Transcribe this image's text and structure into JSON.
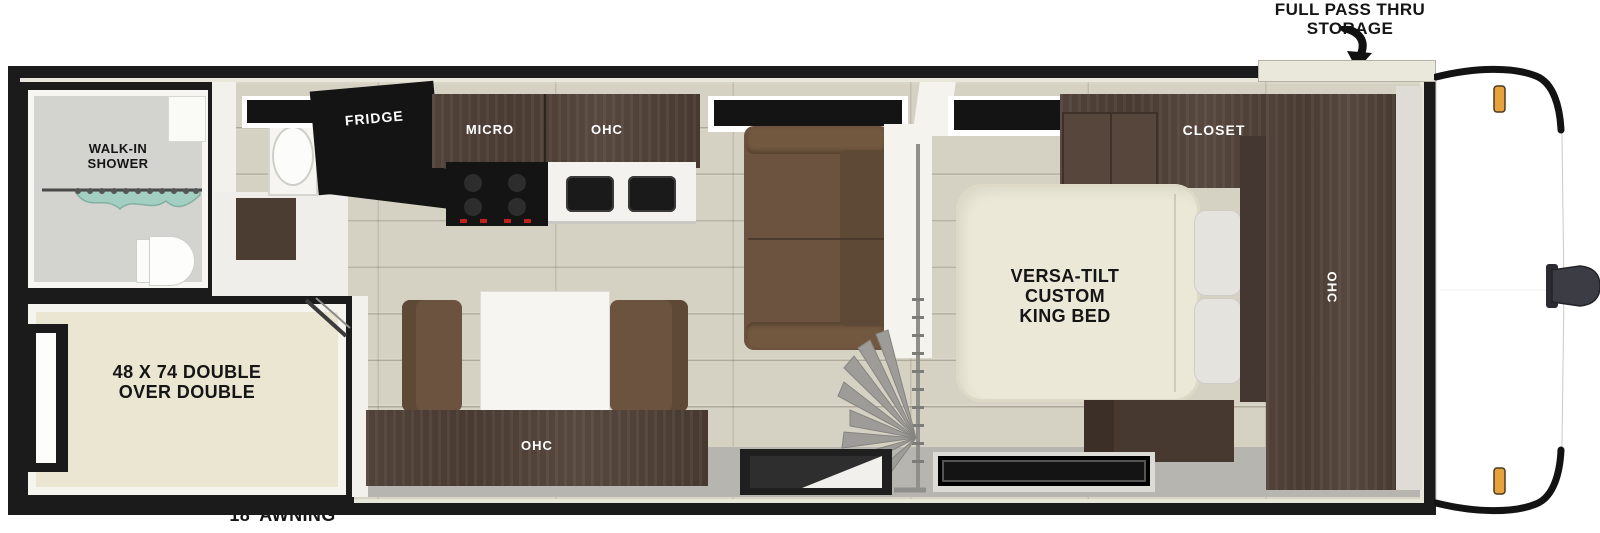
{
  "diagram_type": "rv-travel-trailer-floorplan",
  "annotations": {
    "storage_label_lines": [
      "FULL PASS THRU",
      "STORAGE"
    ],
    "awning_label": "18’ AWNING"
  },
  "bathroom": {
    "shower_label_lines": [
      "WALK-IN",
      "SHOWER"
    ],
    "fixtures": [
      "toilet",
      "round-sink",
      "shower-curtain",
      "vanity"
    ]
  },
  "bunk_room": {
    "bed_label_lines": [
      "48 X 74 DOUBLE",
      "OVER DOUBLE"
    ],
    "fixtures": [
      "window",
      "bunk-ladder"
    ]
  },
  "kitchen": {
    "fridge_label": "FRIDGE",
    "micro_label": "MICRO",
    "ohc_label": "OHC",
    "fixtures": [
      "stove",
      "double-sink",
      "window"
    ]
  },
  "living_area": {
    "fixtures": [
      "sofa",
      "window",
      "privacy-curtain",
      "entry-door"
    ]
  },
  "dinette": {
    "ohc_label": "OHC",
    "fixtures": [
      "table",
      "bench-left",
      "bench-right"
    ]
  },
  "bedroom": {
    "closet_label": "CLOSET",
    "ohc_label": "OHC",
    "bed_label_lines": [
      "VERSA-TILT",
      "CUSTOM",
      "KING BED"
    ],
    "fixtures": [
      "king-bed",
      "pillows",
      "nightstand",
      "window-top",
      "window-bottom"
    ]
  },
  "exterior": {
    "features": [
      "front-cap",
      "hitch",
      "marker-lights",
      "pass-thru-storage-compartment"
    ]
  },
  "colors": {
    "wall_black": "#1b1b1b",
    "trim_cream": "#e9e6da",
    "floor_wood": "#d6d2c3",
    "floor_bath": "#d3d3d0",
    "floor_bunk": "#eae6d2",
    "cabinet_brown": "#4c3d34",
    "sofa_brown": "#6b5340",
    "bed_cream": "#ebe8d7",
    "gray_walk": "#b7b5b0",
    "curtain_teal": "#a5d2c4",
    "marker_amber": "#e6a23c",
    "appliance_black": "#141414"
  }
}
